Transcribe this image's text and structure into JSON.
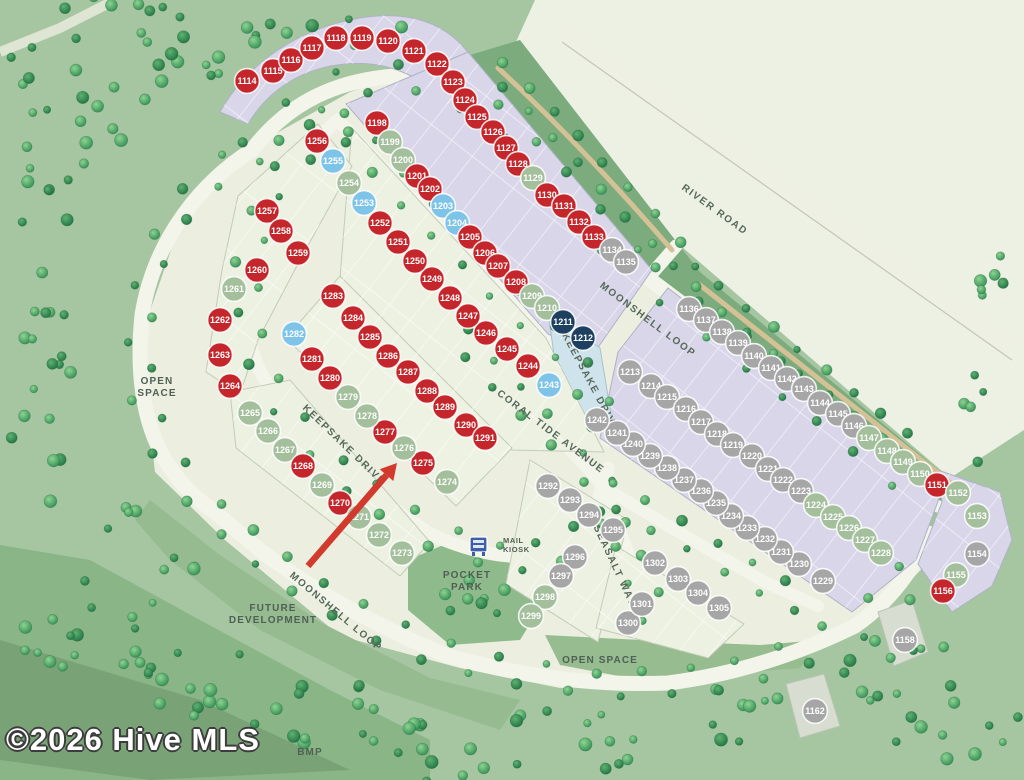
{
  "map": {
    "watermark": "©2026 Hive MLS",
    "status_colors": {
      "r": "#c4262b",
      "g": "#a3bf9c",
      "b": "#7ec3e8",
      "n": "#1d3f60",
      "x": "#a6a6a6"
    },
    "streets": [
      {
        "label": "MOONSHELL LOOP",
        "x": 646,
        "y": 322,
        "rot": 37
      },
      {
        "label": "MOONSHELL LOOP",
        "x": 334,
        "y": 614,
        "rot": 40
      },
      {
        "label": "KEEPSAKE DRIVE",
        "x": 342,
        "y": 447,
        "rot": 44
      },
      {
        "label": "KEEPSAKE DRIVE",
        "x": 588,
        "y": 384,
        "rot": 62
      },
      {
        "label": "CORAL TIDE AVENUE",
        "x": 549,
        "y": 434,
        "rot": 37
      },
      {
        "label": "SEASALT WAY",
        "x": 612,
        "y": 567,
        "rot": 65
      },
      {
        "label": "RIVER ROAD",
        "x": 713,
        "y": 212,
        "rot": 36
      }
    ],
    "areas": [
      {
        "label": "OPEN\nSPACE",
        "x": 157,
        "y": 384
      },
      {
        "label": "POCKET\nPARK",
        "x": 467,
        "y": 578
      },
      {
        "label": "OPEN SPACE",
        "x": 600,
        "y": 663
      },
      {
        "label": "FUTURE\nDEVELOPMENT",
        "x": 273,
        "y": 611
      },
      {
        "label": "BMP",
        "x": 310,
        "y": 755
      },
      {
        "label": "MAIL\nKIOSK",
        "x": 503,
        "y": 543,
        "small": true,
        "align": "start"
      }
    ],
    "arrow": {
      "target_lot": 1276,
      "from": [
        308,
        566
      ],
      "to": [
        397,
        463
      ],
      "color": "#d23a2e"
    },
    "lots": [
      [
        1114,
        247,
        81,
        "r"
      ],
      [
        1115,
        273,
        71,
        "r"
      ],
      [
        1116,
        291,
        60,
        "r"
      ],
      [
        1117,
        312,
        48,
        "r"
      ],
      [
        1118,
        336,
        38,
        "r"
      ],
      [
        1119,
        362,
        38,
        "r"
      ],
      [
        1120,
        388,
        41,
        "r"
      ],
      [
        1121,
        414,
        51,
        "r"
      ],
      [
        1122,
        437,
        64,
        "r"
      ],
      [
        1123,
        453,
        82,
        "r"
      ],
      [
        1124,
        465,
        100,
        "r"
      ],
      [
        1125,
        477,
        117,
        "r"
      ],
      [
        1126,
        493,
        132,
        "r"
      ],
      [
        1127,
        506,
        148,
        "r"
      ],
      [
        1128,
        518,
        164,
        "r"
      ],
      [
        1129,
        533,
        178,
        "g"
      ],
      [
        1130,
        547,
        195,
        "r"
      ],
      [
        1131,
        564,
        206,
        "r"
      ],
      [
        1132,
        579,
        222,
        "r"
      ],
      [
        1133,
        594,
        237,
        "r"
      ],
      [
        1134,
        612,
        250,
        "x"
      ],
      [
        1135,
        626,
        262,
        "x"
      ],
      [
        1136,
        689,
        309,
        "x"
      ],
      [
        1137,
        706,
        320,
        "x"
      ],
      [
        1138,
        722,
        332,
        "x"
      ],
      [
        1139,
        738,
        343,
        "x"
      ],
      [
        1140,
        754,
        356,
        "x"
      ],
      [
        1141,
        771,
        368,
        "x"
      ],
      [
        1142,
        787,
        379,
        "x"
      ],
      [
        1143,
        804,
        389,
        "x"
      ],
      [
        1144,
        820,
        403,
        "x"
      ],
      [
        1145,
        838,
        414,
        "x"
      ],
      [
        1146,
        854,
        426,
        "x"
      ],
      [
        1147,
        869,
        438,
        "g"
      ],
      [
        1148,
        887,
        451,
        "g"
      ],
      [
        1149,
        903,
        462,
        "g"
      ],
      [
        1150,
        920,
        474,
        "g"
      ],
      [
        1151,
        937,
        485,
        "r"
      ],
      [
        1152,
        958,
        493,
        "g"
      ],
      [
        1153,
        977,
        516,
        "g"
      ],
      [
        1154,
        977,
        554,
        "x"
      ],
      [
        1155,
        956,
        575,
        "g"
      ],
      [
        1156,
        943,
        591,
        "r"
      ],
      [
        1158,
        905,
        640,
        "x"
      ],
      [
        1162,
        815,
        711,
        "x"
      ],
      [
        1198,
        377,
        123,
        "r"
      ],
      [
        1199,
        390,
        142,
        "g"
      ],
      [
        1200,
        403,
        160,
        "g"
      ],
      [
        1201,
        417,
        176,
        "r"
      ],
      [
        1202,
        430,
        189,
        "r"
      ],
      [
        1203,
        443,
        206,
        "b"
      ],
      [
        1204,
        457,
        223,
        "b"
      ],
      [
        1205,
        470,
        237,
        "r"
      ],
      [
        1206,
        485,
        253,
        "r"
      ],
      [
        1207,
        498,
        266,
        "r"
      ],
      [
        1208,
        516,
        282,
        "r"
      ],
      [
        1209,
        532,
        296,
        "g"
      ],
      [
        1210,
        547,
        308,
        "g"
      ],
      [
        1211,
        563,
        322,
        "n"
      ],
      [
        1212,
        583,
        338,
        "n"
      ],
      [
        1213,
        630,
        372,
        "x"
      ],
      [
        1214,
        651,
        386,
        "x"
      ],
      [
        1215,
        667,
        397,
        "x"
      ],
      [
        1216,
        686,
        409,
        "x"
      ],
      [
        1217,
        701,
        422,
        "x"
      ],
      [
        1218,
        717,
        434,
        "x"
      ],
      [
        1219,
        733,
        445,
        "x"
      ],
      [
        1220,
        752,
        456,
        "x"
      ],
      [
        1221,
        768,
        469,
        "x"
      ],
      [
        1222,
        783,
        480,
        "x"
      ],
      [
        1223,
        801,
        491,
        "x"
      ],
      [
        1224,
        816,
        505,
        "g"
      ],
      [
        1225,
        833,
        517,
        "g"
      ],
      [
        1226,
        849,
        528,
        "g"
      ],
      [
        1227,
        865,
        540,
        "g"
      ],
      [
        1228,
        881,
        553,
        "g"
      ],
      [
        1229,
        823,
        581,
        "x"
      ],
      [
        1230,
        799,
        564,
        "x"
      ],
      [
        1231,
        781,
        552,
        "x"
      ],
      [
        1232,
        765,
        539,
        "x"
      ],
      [
        1233,
        747,
        528,
        "x"
      ],
      [
        1234,
        731,
        516,
        "x"
      ],
      [
        1235,
        716,
        503,
        "x"
      ],
      [
        1236,
        701,
        491,
        "x"
      ],
      [
        1237,
        684,
        480,
        "x"
      ],
      [
        1238,
        667,
        468,
        "x"
      ],
      [
        1239,
        650,
        456,
        "x"
      ],
      [
        1240,
        633,
        444,
        "x"
      ],
      [
        1241,
        617,
        433,
        "x"
      ],
      [
        1242,
        597,
        420,
        "x"
      ],
      [
        1243,
        549,
        385,
        "b"
      ],
      [
        1244,
        528,
        366,
        "r"
      ],
      [
        1245,
        507,
        349,
        "r"
      ],
      [
        1246,
        486,
        333,
        "r"
      ],
      [
        1247,
        468,
        316,
        "r"
      ],
      [
        1248,
        450,
        298,
        "r"
      ],
      [
        1249,
        432,
        279,
        "r"
      ],
      [
        1250,
        415,
        261,
        "r"
      ],
      [
        1251,
        398,
        242,
        "r"
      ],
      [
        1252,
        380,
        223,
        "r"
      ],
      [
        1253,
        364,
        203,
        "b"
      ],
      [
        1254,
        349,
        183,
        "g"
      ],
      [
        1255,
        333,
        161,
        "b"
      ],
      [
        1256,
        317,
        141,
        "r"
      ],
      [
        1257,
        267,
        211,
        "r"
      ],
      [
        1258,
        281,
        231,
        "r"
      ],
      [
        1259,
        298,
        253,
        "r"
      ],
      [
        1260,
        257,
        270,
        "r"
      ],
      [
        1261,
        234,
        289,
        "g"
      ],
      [
        1262,
        220,
        320,
        "r"
      ],
      [
        1263,
        220,
        355,
        "r"
      ],
      [
        1264,
        230,
        386,
        "r"
      ],
      [
        1265,
        250,
        413,
        "g"
      ],
      [
        1266,
        268,
        431,
        "g"
      ],
      [
        1267,
        285,
        450,
        "g"
      ],
      [
        1268,
        303,
        466,
        "r"
      ],
      [
        1269,
        322,
        485,
        "g"
      ],
      [
        1270,
        340,
        503,
        "r"
      ],
      [
        1271,
        359,
        517,
        "g"
      ],
      [
        1272,
        379,
        535,
        "g"
      ],
      [
        1273,
        402,
        553,
        "g"
      ],
      [
        1274,
        447,
        482,
        "g"
      ],
      [
        1275,
        423,
        463,
        "r"
      ],
      [
        1276,
        404,
        448,
        "g"
      ],
      [
        1277,
        385,
        432,
        "r"
      ],
      [
        1278,
        367,
        416,
        "g"
      ],
      [
        1279,
        348,
        397,
        "g"
      ],
      [
        1280,
        330,
        378,
        "r"
      ],
      [
        1281,
        312,
        359,
        "r"
      ],
      [
        1282,
        294,
        334,
        "b"
      ],
      [
        1283,
        333,
        296,
        "r"
      ],
      [
        1284,
        353,
        318,
        "r"
      ],
      [
        1285,
        370,
        337,
        "r"
      ],
      [
        1286,
        388,
        356,
        "r"
      ],
      [
        1287,
        408,
        372,
        "r"
      ],
      [
        1288,
        427,
        391,
        "r"
      ],
      [
        1289,
        445,
        407,
        "r"
      ],
      [
        1290,
        466,
        425,
        "r"
      ],
      [
        1291,
        485,
        438,
        "r"
      ],
      [
        1292,
        548,
        486,
        "x"
      ],
      [
        1293,
        570,
        500,
        "x"
      ],
      [
        1294,
        589,
        515,
        "x"
      ],
      [
        1295,
        613,
        530,
        "x"
      ],
      [
        1296,
        575,
        557,
        "x"
      ],
      [
        1297,
        561,
        576,
        "x"
      ],
      [
        1298,
        545,
        597,
        "g"
      ],
      [
        1299,
        531,
        616,
        "g"
      ],
      [
        1300,
        628,
        623,
        "x"
      ],
      [
        1301,
        642,
        604,
        "x"
      ],
      [
        1302,
        655,
        563,
        "x"
      ],
      [
        1303,
        678,
        579,
        "x"
      ],
      [
        1304,
        698,
        593,
        "x"
      ],
      [
        1305,
        719,
        608,
        "x"
      ]
    ]
  }
}
